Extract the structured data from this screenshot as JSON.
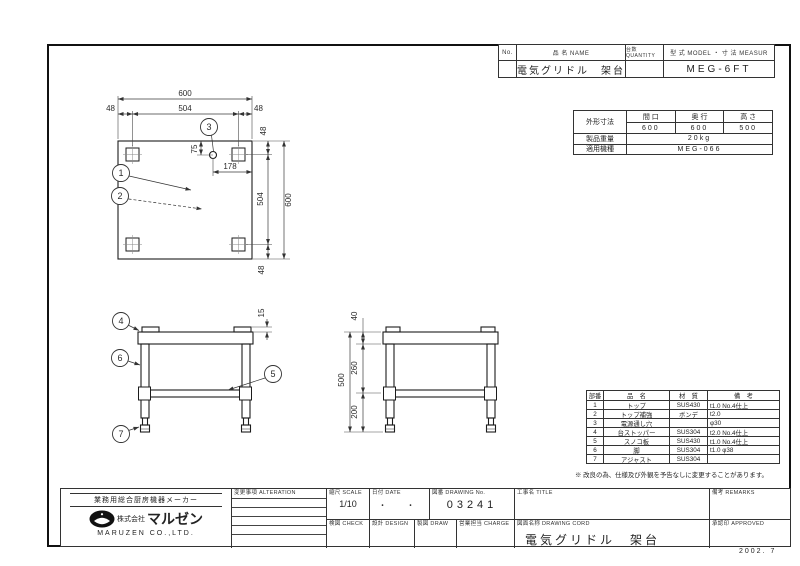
{
  "sheet": {
    "date_stamp": "2002. 7"
  },
  "header_table": {
    "no_label": "No.",
    "name_label": "品 名 NAME",
    "qty_label": "台数 QUANTITY",
    "model_label": "型 式 MODEL ・ 寸 法 MEASUR",
    "name_value": "電気グリドル　架台",
    "model_value": "MEG-6FT"
  },
  "spec_table": {
    "outer_dims_label": "外形寸法",
    "width_label": "間 口",
    "depth_label": "奥 行",
    "height_label": "高 さ",
    "width_value": "600",
    "depth_value": "600",
    "height_value": "500",
    "weight_label": "製品重量",
    "weight_value": "20kg",
    "model_label": "適用機種",
    "model_value": "MEG-066"
  },
  "parts_table": {
    "no_header": "部番",
    "name_header": "品　名",
    "material_header": "材　質",
    "remarks_header": "備　考",
    "rows": [
      {
        "no": "1",
        "name": "トップ",
        "material": "SUS430",
        "remarks": "t1.0 No.4仕上"
      },
      {
        "no": "2",
        "name": "トップ補強",
        "material": "ボンデ",
        "remarks": "t2.0"
      },
      {
        "no": "3",
        "name": "電源通し穴",
        "material": "",
        "remarks": "φ30"
      },
      {
        "no": "4",
        "name": "台ストッパー",
        "material": "SUS304",
        "remarks": "t2.0 No.4仕上"
      },
      {
        "no": "5",
        "name": "スノコ板",
        "material": "SUS430",
        "remarks": "t1.0 No.4仕上"
      },
      {
        "no": "6",
        "name": "脚",
        "material": "SUS304",
        "remarks": "t1.0 φ38"
      },
      {
        "no": "7",
        "name": "アジャスト",
        "material": "SUS304",
        "remarks": ""
      }
    ],
    "note": "※ 改良の為、仕様及び外観を予告なしに変更することがあります。"
  },
  "title_block": {
    "maker_tagline": "業務用総合厨房機器メーカー",
    "company_prefix": "株式会社",
    "company_logotype": "マルゼン",
    "company_en": "MARUZEN CO.,LTD.",
    "alteration_label": "変更事項 ALTERATION",
    "scale_label": "縮尺 SCALE",
    "scale_value": "1/10",
    "date_label": "日付 DATE",
    "date_value": "・　・",
    "drawing_no_label": "図番 DRAWING No.",
    "drawing_no_value": "03241",
    "title_label": "工事名 TITLE",
    "check_label": "検図 CHECK",
    "design_label": "設計 DESIGN",
    "draw_label": "製図 DRAW",
    "charge_label": "営業担当 CHARGE",
    "drawing_name_label": "図面名称 DRAWING CORD",
    "drawing_name_value": "電気グリドル　架台",
    "remarks_label": "備考 REMARKS",
    "approved_label": "承認印 APPROVED"
  },
  "drawing": {
    "balloons": {
      "b1": "1",
      "b2": "2",
      "b3": "3",
      "b4": "4",
      "b5": "5",
      "b6": "6",
      "b7": "7"
    },
    "top_view": {
      "dim_width": "600",
      "dim_inner": "504",
      "dim_left": "48",
      "dim_right": "48",
      "dim_top": "48",
      "dim_inner_v": "504",
      "dim_height": "600",
      "dim_bottom": "48",
      "dim_hole_y": "75",
      "dim_hole_x": "178"
    },
    "front_view": {
      "dim_stopper": "15"
    },
    "side_view": {
      "dim_top": "40",
      "dim_mid": "260",
      "dim_lower": "200",
      "dim_total": "500"
    }
  }
}
